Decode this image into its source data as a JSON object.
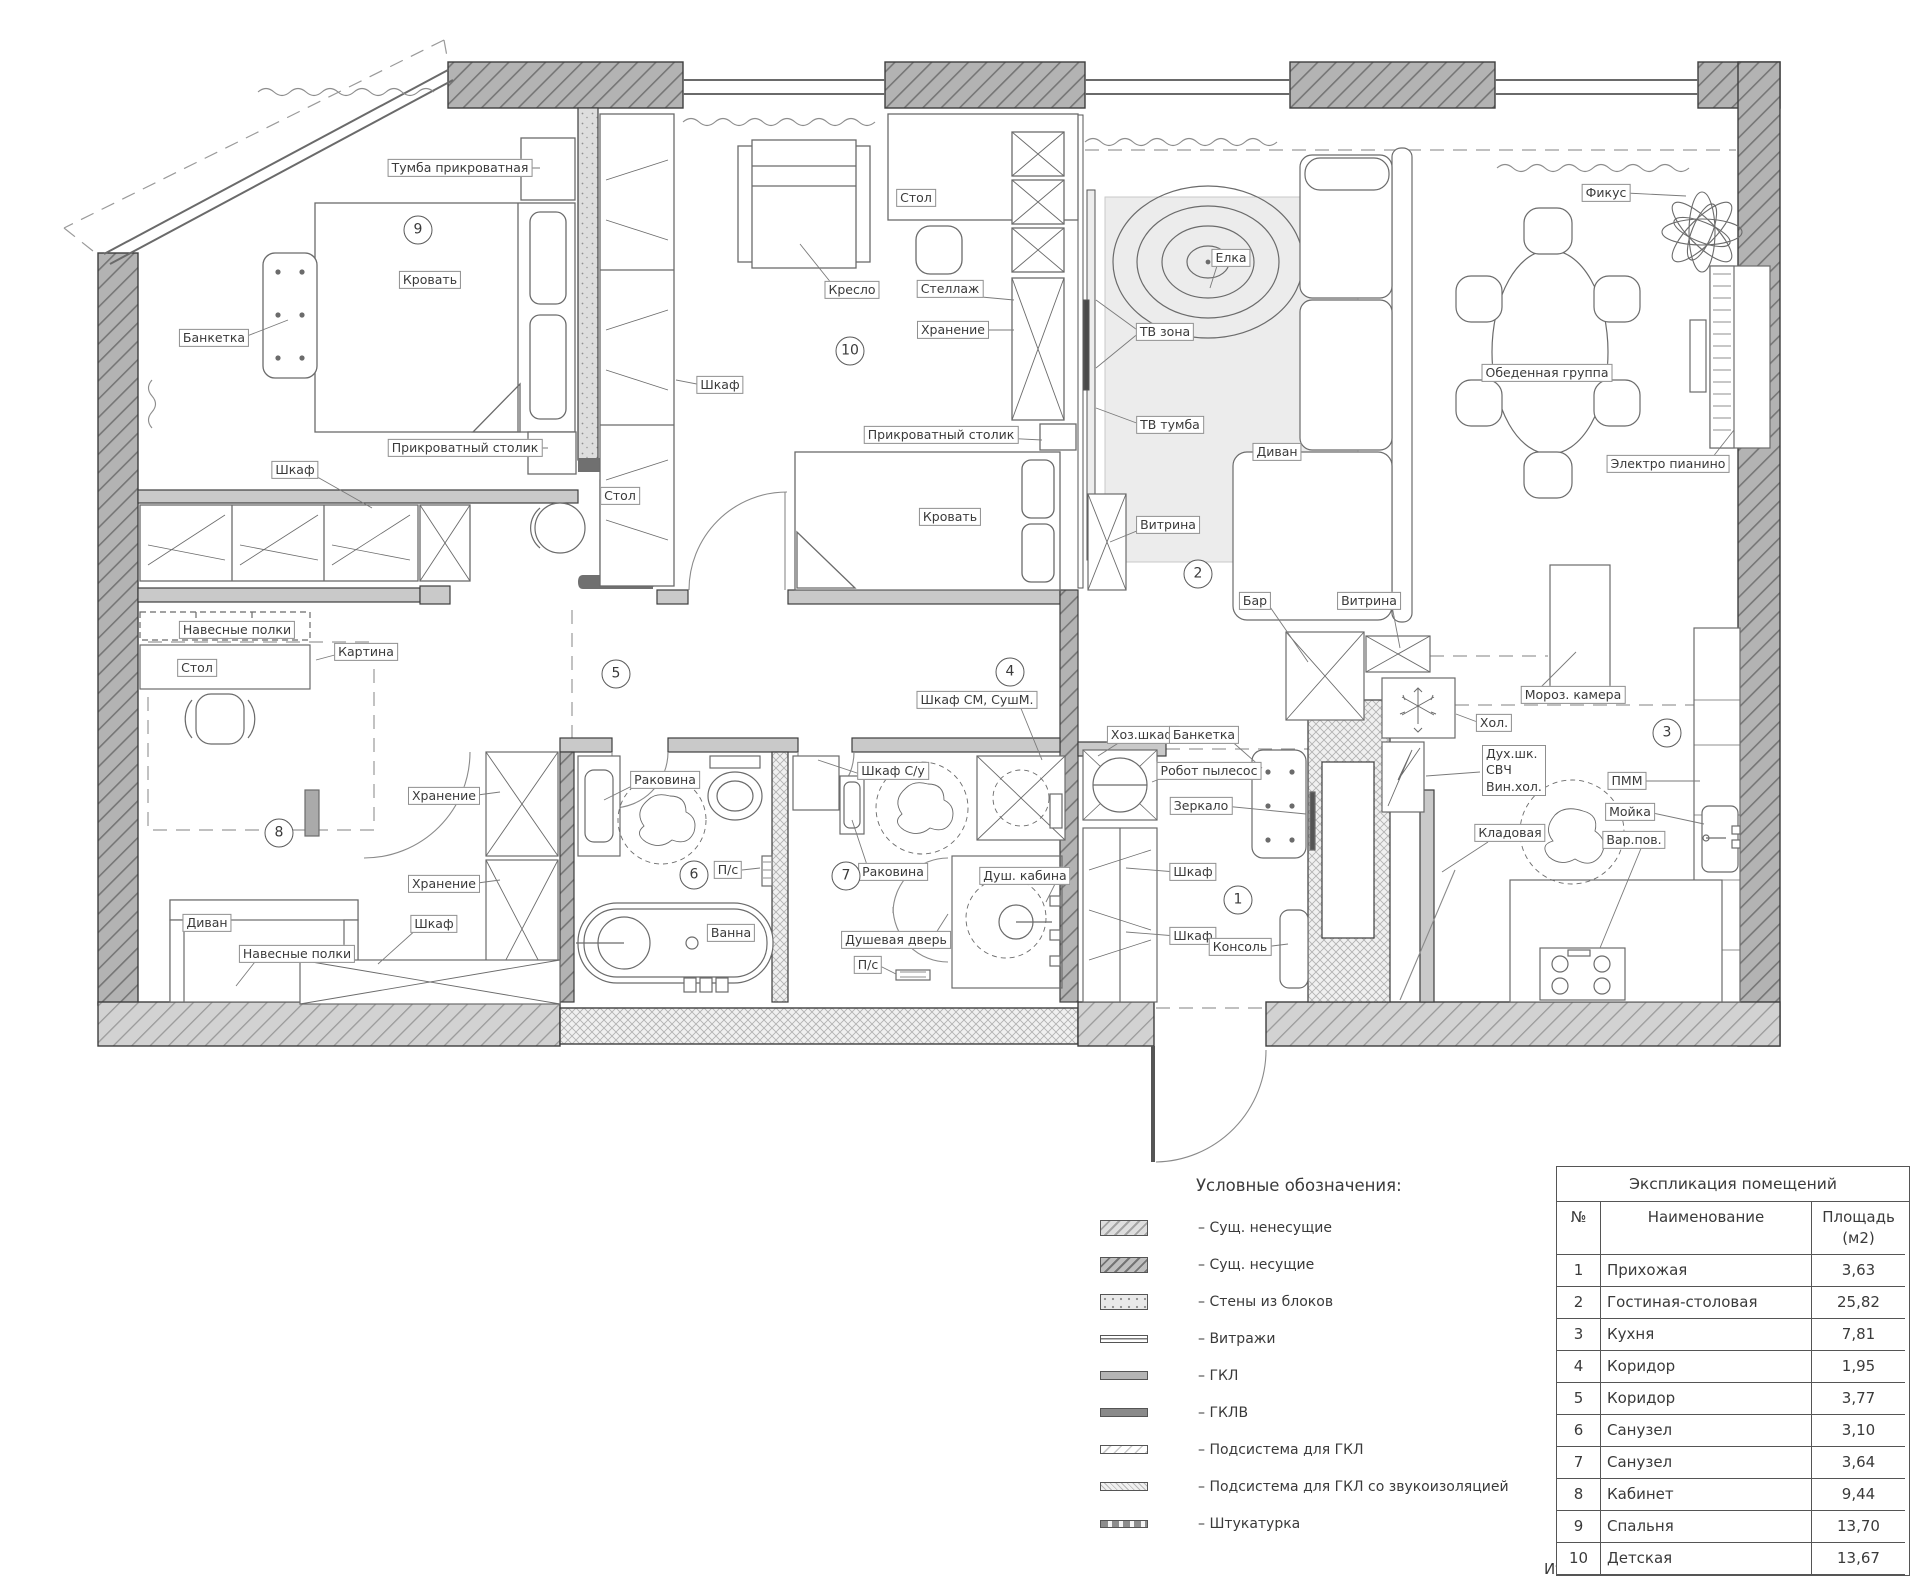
{
  "colors": {
    "wall_dark": "#b3b3b3",
    "wall_hatch": "#767676",
    "wall_light": "#c9c9c9",
    "block_wall": "#dedede",
    "carpet": "#ececec",
    "line": "#4a4a4a"
  },
  "labels": {
    "tumba": "Тумба прикроватная",
    "krovat": "Кровать",
    "banketka": "Банкетка",
    "prikrovatny_stolik": "Прикроватный столик",
    "shkaf": "Шкаф",
    "stol": "Стол",
    "navesnye_polki": "Навесные полки",
    "kartina": "Картина",
    "kreslo": "Кресло",
    "stellazh": "Стеллаж",
    "khranenie": "Хранение",
    "elka": "Елка",
    "tv_zona": "ТВ зона",
    "tv_tumba": "ТВ тумба",
    "vitrina": "Витрина",
    "divan": "Диван",
    "fikus": "Фикус",
    "obed_gruppa": "Обеденная группа",
    "e_pianino": "Электро пианино",
    "bar": "Бар",
    "moroz_kamera": "Мороз. камера",
    "khol": "Хол.",
    "dukh_shk": "Дух.шк.\nСВЧ\nВин.хол.",
    "pmm": "ПММ",
    "moyka": "Мойка",
    "var_pov": "Вар.пов.",
    "kladovaya": "Кладовая",
    "khoz_shkaf": "Хоз.шкаф",
    "robot_pylesos": "Робот пылесос",
    "zerkalo": "Зеркало",
    "konsol": "Консоль",
    "shkaf_sm": "Шкаф СМ, СушМ.",
    "shkaf_su": "Шкаф С/у",
    "rakovina": "Раковина",
    "ps": "П/с",
    "vanna": "Ванна",
    "dush_kabina": "Душ. кабина",
    "dush_dver": "Душевая дверь"
  },
  "room_numbers": [
    "1",
    "2",
    "3",
    "4",
    "5",
    "6",
    "7",
    "8",
    "9",
    "10"
  ],
  "legend": {
    "title": "Условные обозначения:",
    "items": [
      "– Сущ. ненесущие",
      "– Сущ. несущие",
      "– Стены из блоков",
      "– Витражи",
      "– ГКЛ",
      "– ГКЛВ",
      "– Подсистема для ГКЛ",
      "– Подсистема для ГКЛ со звукоизоляцией",
      "– Штукатурка"
    ]
  },
  "table": {
    "title": "Экспликация помещений",
    "columns": [
      "№",
      "Наименование",
      "Площадь (м2)"
    ],
    "rows": [
      {
        "num": "1",
        "name": "Прихожая",
        "area": "3,63"
      },
      {
        "num": "2",
        "name": "Гостиная-столовая",
        "area": "25,82"
      },
      {
        "num": "3",
        "name": "Кухня",
        "area": "7,81"
      },
      {
        "num": "4",
        "name": "Коридор",
        "area": "1,95"
      },
      {
        "num": "5",
        "name": "Коридор",
        "area": "3,77"
      },
      {
        "num": "6",
        "name": "Санузел",
        "area": "3,10"
      },
      {
        "num": "7",
        "name": "Санузел",
        "area": "3,64"
      },
      {
        "num": "8",
        "name": "Кабинет",
        "area": "9,44"
      },
      {
        "num": "9",
        "name": "Спальня",
        "area": "13,70"
      },
      {
        "num": "10",
        "name": "Детская",
        "area": "13,67"
      }
    ],
    "total_label": "Итого",
    "total_value": "86,52"
  }
}
